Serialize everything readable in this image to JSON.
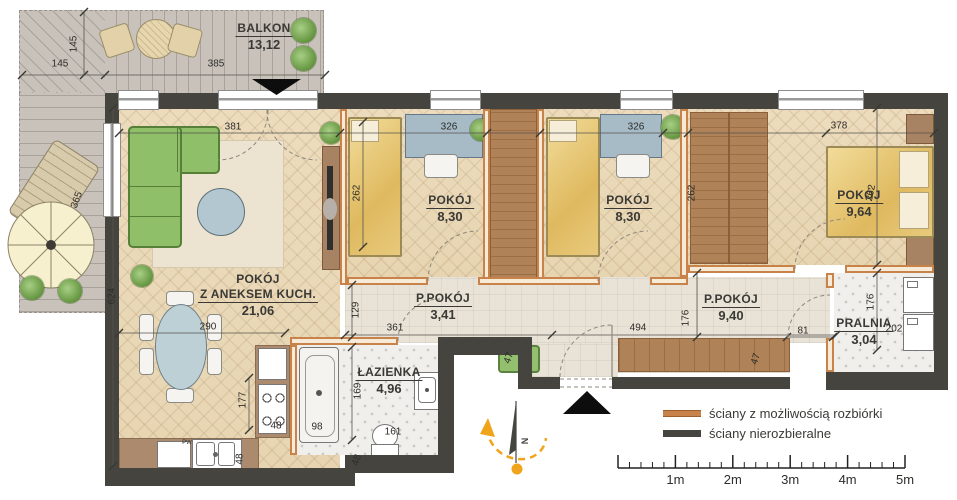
{
  "plan": {
    "rooms": [
      {
        "name": "BALKON",
        "area": "13,12",
        "x": 264,
        "y": 21
      },
      {
        "name": "POKÓJ",
        "name2": "Z ANEKSEM KUCH.",
        "area": "21,06",
        "x": 258,
        "y": 272
      },
      {
        "name": "POKÓJ",
        "area": "8,30",
        "x": 450,
        "y": 193
      },
      {
        "name": "POKÓJ",
        "area": "8,30",
        "x": 628,
        "y": 193
      },
      {
        "name": "POKÓJ",
        "area": "9,64",
        "x": 859,
        "y": 188
      },
      {
        "name": "P.POKÓJ",
        "area": "3,41",
        "x": 443,
        "y": 291
      },
      {
        "name": "P.POKÓJ",
        "area": "9,40",
        "x": 731,
        "y": 292
      },
      {
        "name": "ŁAZIENKA",
        "area": "4,96",
        "x": 389,
        "y": 365
      },
      {
        "name": "PRALNIA",
        "area": "3,04",
        "x": 864,
        "y": 316
      }
    ],
    "dimensions": [
      {
        "t": "145",
        "x": 60,
        "y": 64,
        "r": 0
      },
      {
        "t": "145",
        "x": 74,
        "y": 44,
        "r": -90
      },
      {
        "t": "385",
        "x": 216,
        "y": 64,
        "r": 0
      },
      {
        "t": "365",
        "x": 77,
        "y": 200,
        "r": -70
      },
      {
        "t": "381",
        "x": 233,
        "y": 127,
        "r": 0
      },
      {
        "t": "326",
        "x": 449,
        "y": 127,
        "r": 0
      },
      {
        "t": "326",
        "x": 636,
        "y": 127,
        "r": 0
      },
      {
        "t": "378",
        "x": 839,
        "y": 126,
        "r": 0
      },
      {
        "t": "262",
        "x": 357,
        "y": 193,
        "r": -90
      },
      {
        "t": "262",
        "x": 692,
        "y": 193,
        "r": -90
      },
      {
        "t": "262",
        "x": 871,
        "y": 193,
        "r": -78
      },
      {
        "t": "624",
        "x": 112,
        "y": 296,
        "r": -90
      },
      {
        "t": "290",
        "x": 208,
        "y": 327,
        "r": 0
      },
      {
        "t": "129",
        "x": 356,
        "y": 310,
        "r": -90
      },
      {
        "t": "361",
        "x": 395,
        "y": 328,
        "r": 0
      },
      {
        "t": "494",
        "x": 638,
        "y": 328,
        "r": 0
      },
      {
        "t": "176",
        "x": 686,
        "y": 318,
        "r": -90
      },
      {
        "t": "176",
        "x": 871,
        "y": 302,
        "r": -90
      },
      {
        "t": "81",
        "x": 803,
        "y": 331,
        "r": 0
      },
      {
        "t": "202",
        "x": 894,
        "y": 329,
        "r": 0
      },
      {
        "t": "47",
        "x": 509,
        "y": 358,
        "r": -72
      },
      {
        "t": "47",
        "x": 756,
        "y": 359,
        "r": -72
      },
      {
        "t": "177",
        "x": 243,
        "y": 400,
        "r": -90
      },
      {
        "t": "48",
        "x": 276,
        "y": 426,
        "r": 0
      },
      {
        "t": "98",
        "x": 317,
        "y": 427,
        "r": 0
      },
      {
        "t": "48",
        "x": 240,
        "y": 459,
        "r": -90
      },
      {
        "t": "169",
        "x": 358,
        "y": 391,
        "r": -90
      },
      {
        "t": "161",
        "x": 393,
        "y": 432,
        "r": 0
      },
      {
        "t": "48",
        "x": 357,
        "y": 460,
        "r": -72
      },
      {
        "t": "PW",
        "x": 187,
        "y": 443,
        "r": 0,
        "s": 6
      }
    ],
    "legend": {
      "items": [
        {
          "label": "ściany z możliwością rozbiórki",
          "color": "#c8834b"
        },
        {
          "label": "ściany nierozbieralne",
          "color": "#45443f"
        }
      ]
    },
    "scalebar": {
      "labels": [
        "1m",
        "2m",
        "3m",
        "4m",
        "5m"
      ]
    },
    "compass": {
      "north_label": "N"
    },
    "colors": {
      "demolishable_wall": "#c8834b",
      "structural_wall": "#45443f",
      "accent_marker": "#f0a41c",
      "wood_floor": "#e9d8ba",
      "sofa_green": "#8fbf69"
    }
  }
}
